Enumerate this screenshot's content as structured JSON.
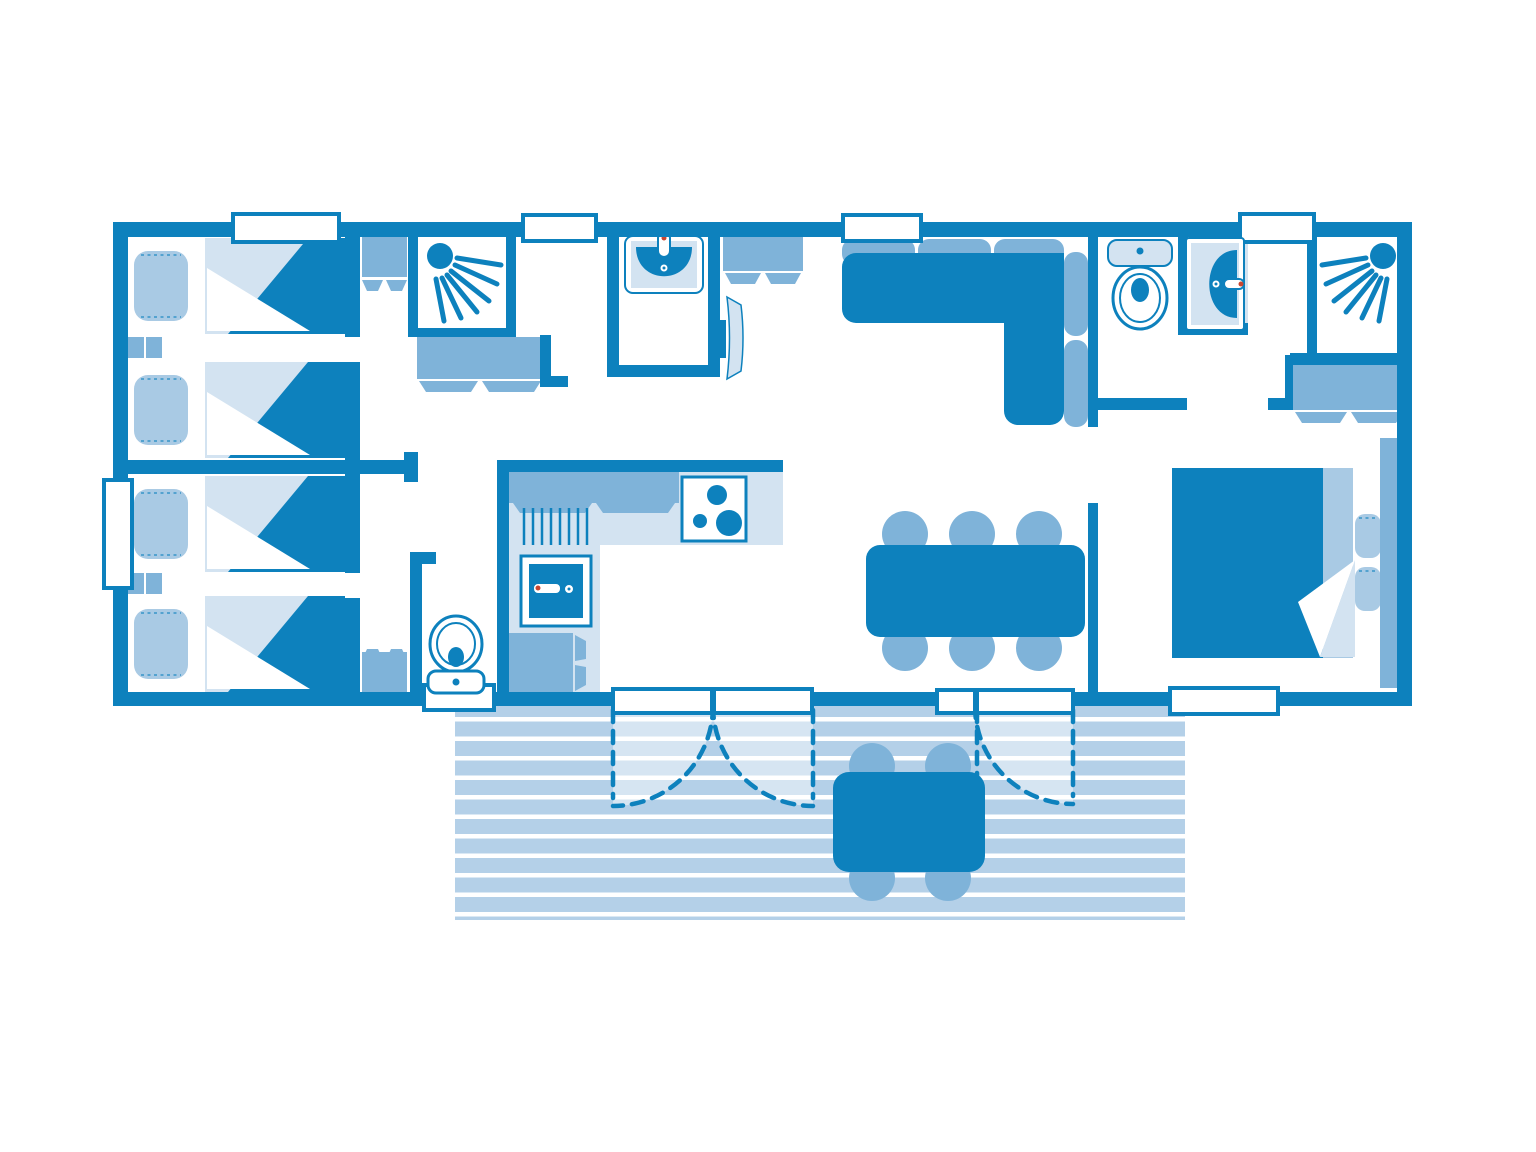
{
  "colors": {
    "primary": "#0d81bd",
    "mid": "#7fb3d9",
    "soft": "#a9cae4",
    "pale": "#d3e3f1",
    "faint": "#e9f0f8",
    "stripe": "#b4d0e8",
    "red": "#c9452f",
    "background": "#ffffff"
  },
  "floorplan": {
    "type": "mobile-home-floor-plan",
    "rooms": [
      "twin-bedroom-left-top",
      "twin-bedroom-left-bottom",
      "hallway",
      "shower-room-left",
      "washroom-with-basin",
      "wc-left",
      "kitchen",
      "living-dining-area",
      "wc-right",
      "washbasin-nook-right",
      "shower-room-right",
      "master-bedroom",
      "terrace"
    ],
    "furniture_icons": [
      "single-bed-icon",
      "single-bed-icon",
      "single-bed-icon",
      "single-bed-icon",
      "double-bed-icon",
      "nightstand-icon",
      "nightstand-icon",
      "wardrobe-icon",
      "wardrobe-icon",
      "wardrobe-icon",
      "tall-cabinet-icon",
      "vanity-cabinet-icon",
      "shower-icon",
      "shower-icon",
      "washbasin-icon",
      "washbasin-icon",
      "toilet-icon",
      "toilet-icon",
      "kitchen-counter-icon",
      "kitchen-sink-icon",
      "hob-burners-icon",
      "base-cabinet-icon",
      "tv-icon",
      "corner-sofa-icon",
      "dining-table-icon",
      "dining-chair-icon",
      "outdoor-table-icon",
      "outdoor-chair-icon",
      "door-swing-icon",
      "window-icon"
    ],
    "counts": {
      "single_beds": 4,
      "double_beds": 1,
      "showers": 2,
      "toilets": 2,
      "washbasins": 2,
      "dining_chairs": 6,
      "outdoor_chairs": 4,
      "windows": 7,
      "terrace_doors": 3
    }
  }
}
